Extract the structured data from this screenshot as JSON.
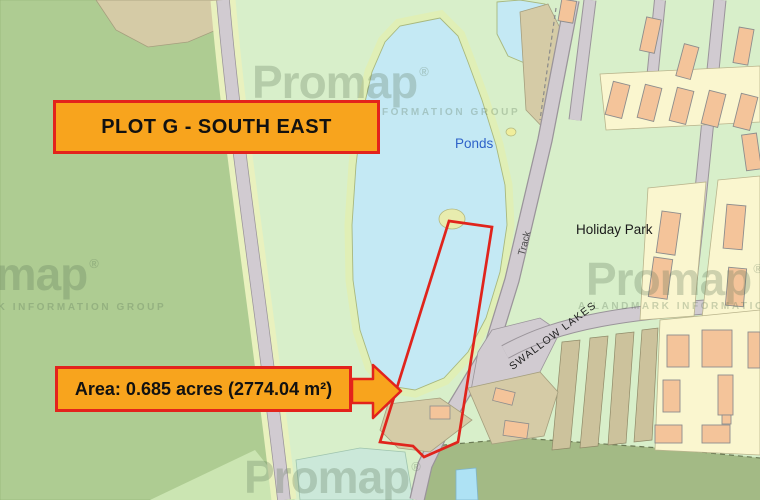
{
  "banner": {
    "label": "PLOT G - SOUTH EAST"
  },
  "area_callout": {
    "label": "Area: 0.685 acres (2774.04 m²)"
  },
  "map_labels": {
    "ponds": "Ponds",
    "holiday_park": "Holiday Park",
    "track": "Track",
    "swallow_lakes": "SWALLOW LAKES"
  },
  "watermark": {
    "brand": "Promap",
    "registered": "®",
    "caption": "A LANDMARK INFORMATION GROUP"
  },
  "colors": {
    "annotation_fill": "#F8A41D",
    "annotation_border": "#E3231C",
    "plot_outline": "#E0241C",
    "pond_fill": "#C4E9F4",
    "pond_margin": "#E0EFB6",
    "field_light": "#D8EFCA",
    "field_medium": "#AECC92",
    "field_dark": "#A3BA85",
    "parcel_tan": "#D5CBA6",
    "building_salmon": "#F4C49A",
    "plot_cream": "#FAF6CF",
    "road_grey": "#D1CBD1",
    "marsh_teal": "#CBE8D9",
    "ponds_label_blue": "#2E62C8"
  }
}
